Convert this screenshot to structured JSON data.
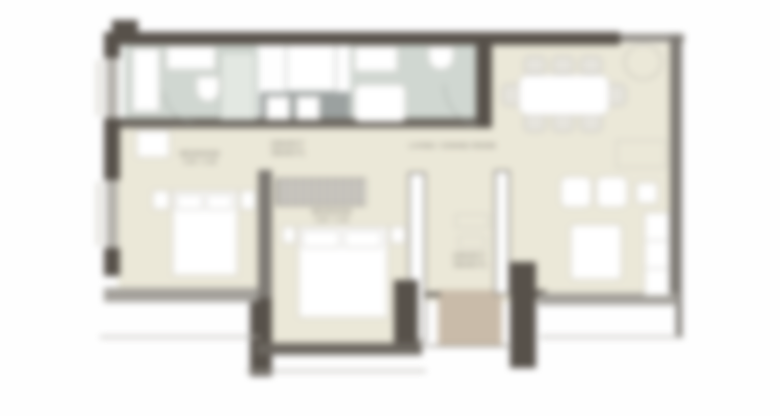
{
  "plan": {
    "type": "apartment-floor-plan",
    "style": "blurred architectural drawing, top-down",
    "colors": {
      "background": "#fefefe",
      "floor_main": "#ebe8d8",
      "floor_bathroom_tile": "#d0d7d1",
      "floor_entry_wood": "#c9bba9",
      "wall_dark": "#57514a",
      "wall_medium": "#7d7973",
      "window_band": "#b5b2ac",
      "furniture_fill": "#ffffff",
      "label_text": "#6b665f"
    },
    "labels": {
      "master_bedroom": {
        "name": "BEDROOM",
        "dims": "4.05 × 3.45"
      },
      "bedroom_2": {
        "name": "BEDROOM",
        "dims": "3.90 × 3.35"
      },
      "living": {
        "name": "LIVING / DINING ROOM"
      },
      "laundry": {
        "name": "LAUNDRY"
      },
      "hall": {
        "name": "HALL"
      }
    },
    "rooms": [
      {
        "name": "bathroom-1",
        "position": "top-left",
        "floor": "tile"
      },
      {
        "name": "laundry-shaft",
        "position": "top-center",
        "floor": "white"
      },
      {
        "name": "bathroom-2",
        "position": "top-center-right",
        "floor": "tile"
      },
      {
        "name": "living-dining-room",
        "position": "right",
        "floor": "beige"
      },
      {
        "name": "master-bedroom",
        "position": "left",
        "floor": "beige"
      },
      {
        "name": "bedroom-2",
        "position": "center",
        "floor": "beige"
      },
      {
        "name": "hall-corridor",
        "position": "center-right",
        "floor": "beige"
      },
      {
        "name": "entry",
        "position": "bottom-center",
        "floor": "wood"
      },
      {
        "name": "balcony-strips",
        "position": "bottom",
        "floor": "white"
      }
    ],
    "furniture": [
      "bed-master",
      "nightstands",
      "desk",
      "wardrobe-sliding",
      "bed-2",
      "dining-table",
      "dining-chairs-8",
      "plant",
      "armchairs-2",
      "side-table",
      "coffee-table",
      "tv-unit",
      "vanity",
      "toilet",
      "shower",
      "bathtub",
      "washer-dryer"
    ]
  }
}
